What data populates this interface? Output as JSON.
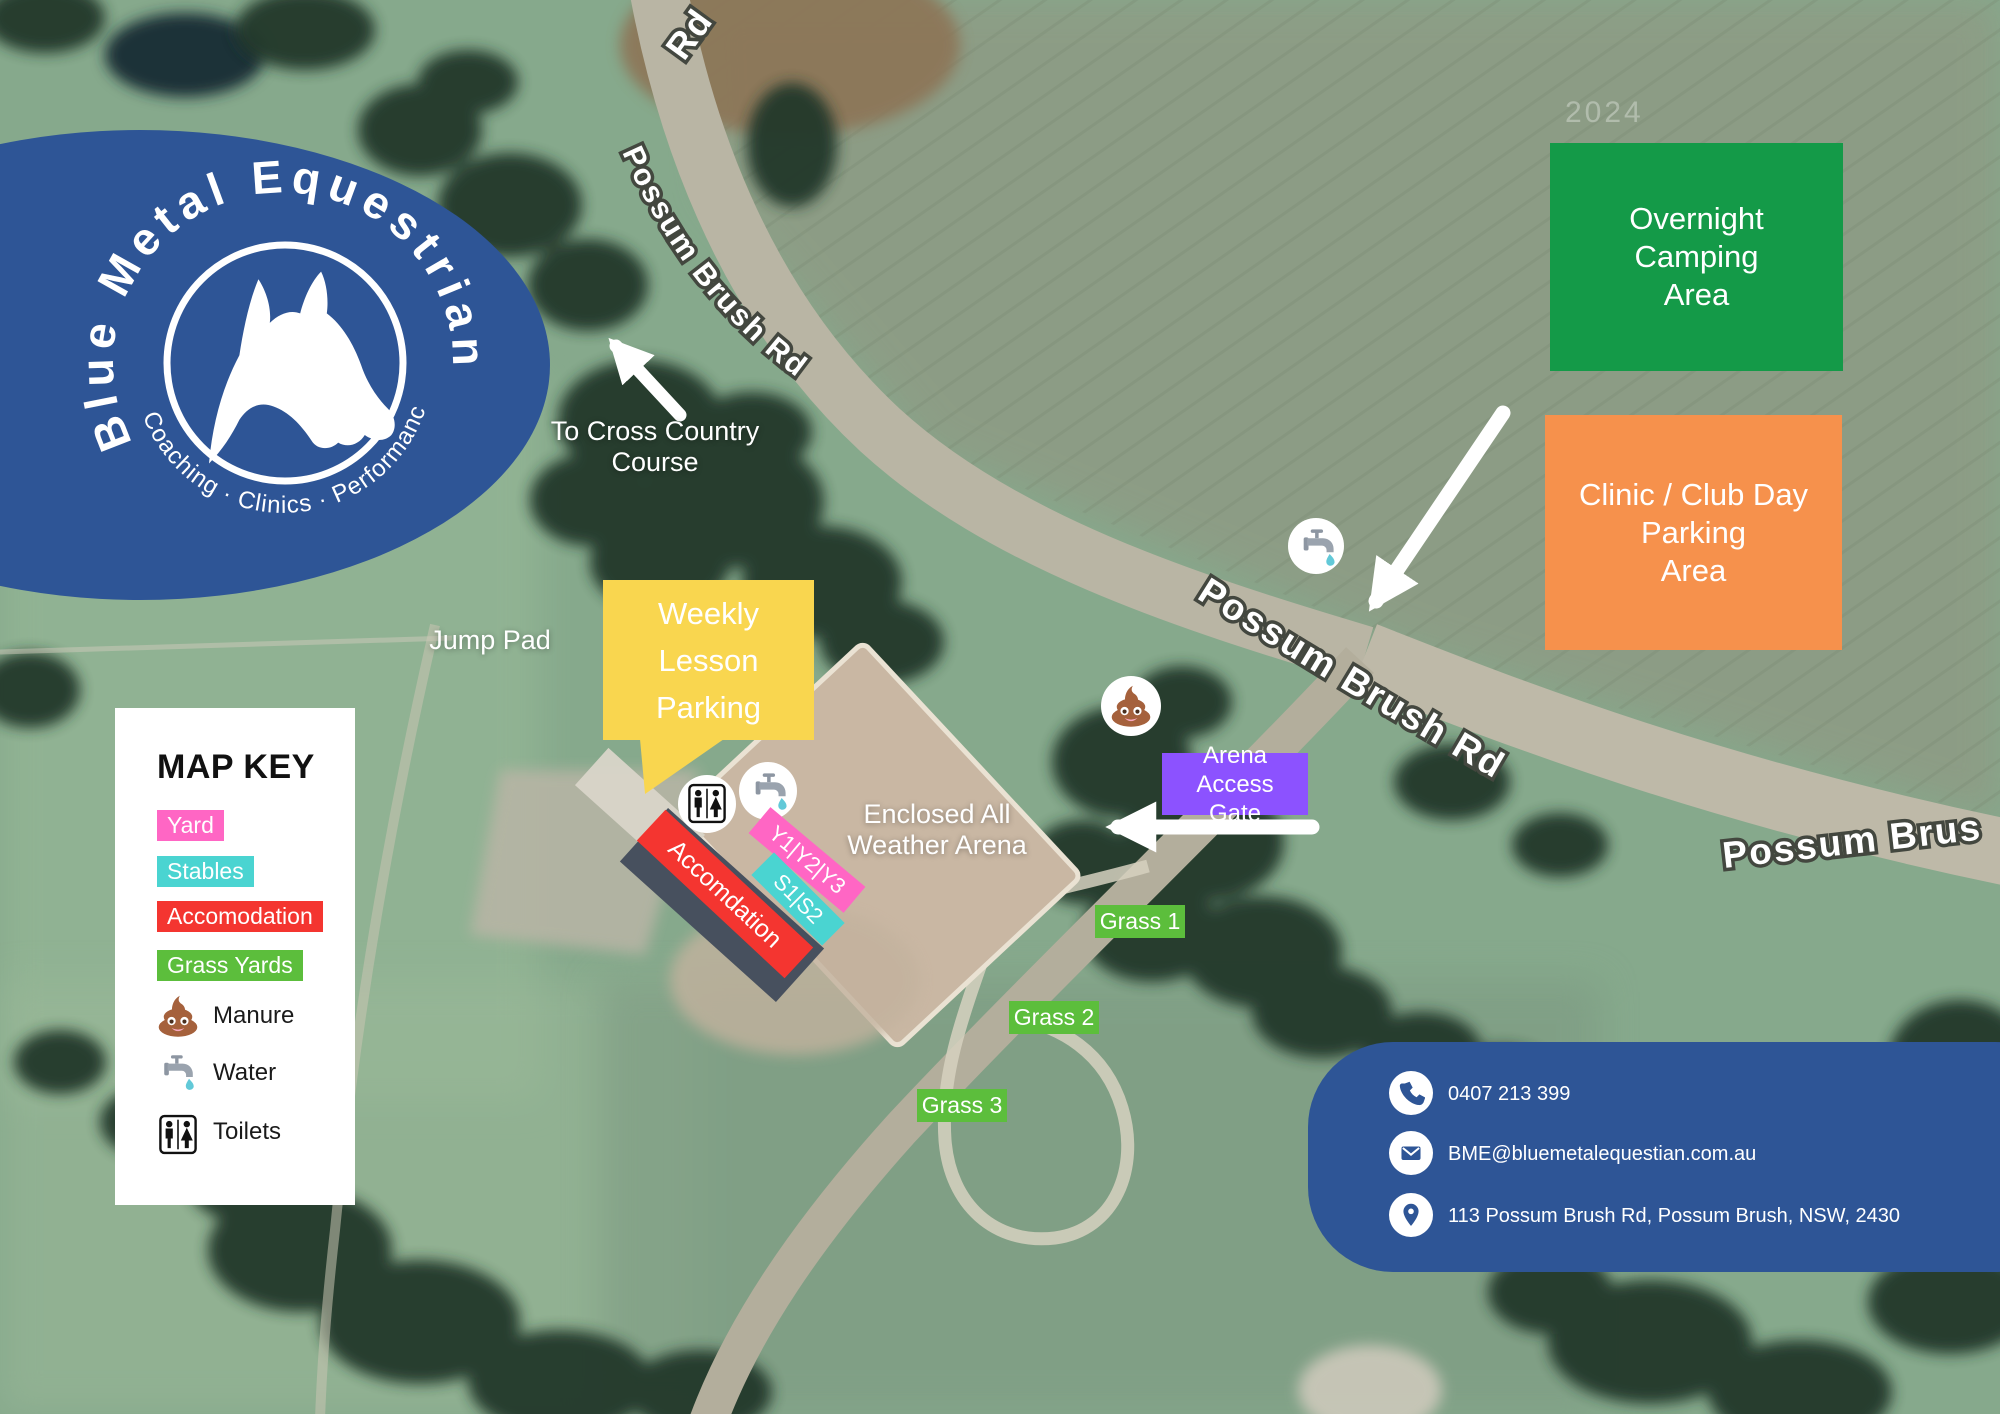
{
  "logo": {
    "brand": "Blue Metal Equestrian",
    "tagline": "Coaching · Clinics · Performance",
    "color": "#2e5596"
  },
  "roads": {
    "top": "Rd",
    "upper": "Possum Brush Rd",
    "middle": "Possum Brush Rd",
    "right": "Possum Brus"
  },
  "labels": {
    "cross_country_line1": "To Cross Country",
    "cross_country_line2": "Course",
    "jump_pad": "Jump Pad",
    "arena_line1": "Enclosed All",
    "arena_line2": "Weather Arena",
    "watermark": "2024"
  },
  "boxes": {
    "camping": {
      "line1": "Overnight",
      "line2": "Camping",
      "line3": "Area",
      "color": "#149a48"
    },
    "clinic": {
      "line1": "Clinic / Club Day",
      "line2": "Parking",
      "line3": "Area",
      "color": "#f6914c"
    },
    "weekly": {
      "line1": "Weekly",
      "line2": "Lesson",
      "line3": "Parking",
      "color": "#f9d64f"
    },
    "gate": {
      "line1": "Arena Access",
      "line2": "Gate",
      "color": "#8c52ff"
    }
  },
  "strips": {
    "accommodation": {
      "label": "Accomdation",
      "color": "#f43530"
    },
    "yards": {
      "label": "Y1|Y2|Y3",
      "color": "#ff66c4"
    },
    "stables": {
      "label": "S1|S2",
      "color": "#4ad4d1"
    }
  },
  "grass": [
    "Grass 1",
    "Grass 2",
    "Grass 3"
  ],
  "grass_color": "#5cbe3c",
  "map_key": {
    "title": "MAP KEY",
    "swatches": [
      {
        "label": "Yard",
        "color": "#ff66c4"
      },
      {
        "label": "Stables",
        "color": "#4ad4d1"
      },
      {
        "label": "Accomodation",
        "color": "#f43530"
      },
      {
        "label": "Grass Yards",
        "color": "#5cbe3c"
      }
    ],
    "legend": [
      {
        "icon": "manure-icon",
        "label": "Manure"
      },
      {
        "icon": "water-icon",
        "label": "Water"
      },
      {
        "icon": "toilets-icon",
        "label": "Toilets"
      }
    ]
  },
  "contact": {
    "phone": "0407 213 399",
    "email": "BME@bluemetalequestian.com.au",
    "address": "113 Possum Brush Rd, Possum Brush, NSW, 2430",
    "panel_color": "#2e5596"
  }
}
